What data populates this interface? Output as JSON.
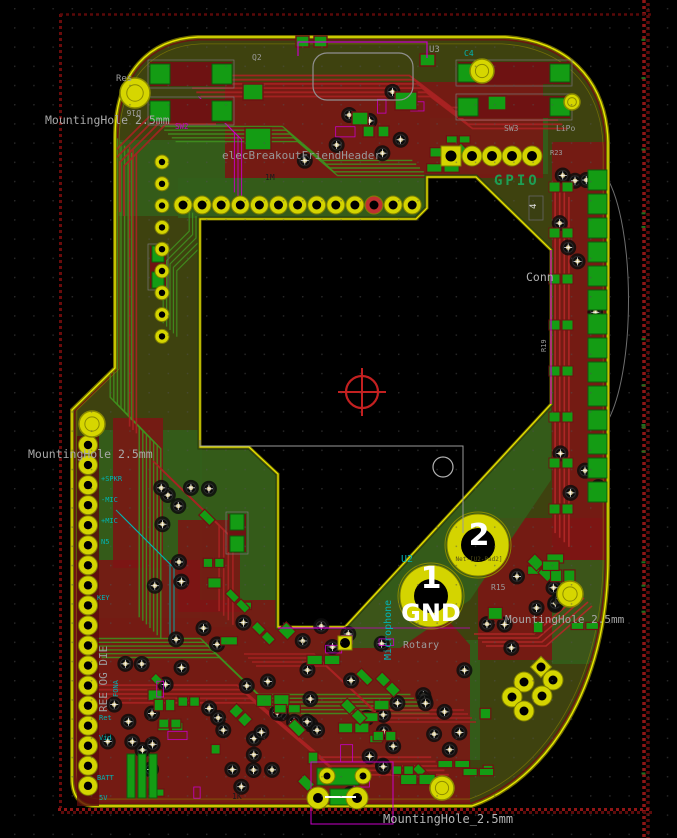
{
  "editor": {
    "view": "pcb-layout",
    "board_name": "elecBreakoutFriendHeader"
  },
  "palette": {
    "bg": "#000000",
    "grid_dot": "#505050",
    "board_base": "#3e420f",
    "zone_green": "#335f1b",
    "zone_red": "#7e1414",
    "trace_green": "#3f8f1e",
    "trace_red": "#a82222",
    "pad_yellow": "#d4d400",
    "pad_yellow_edge": "#7f7f00",
    "pad_green": "#149c14",
    "courtyard_red": "#6e1212",
    "edge_bright": "#e8e800",
    "edge_dim": "#6f6a00",
    "magenta": "#c800c8",
    "cyan": "#00b4b4",
    "gray_text": "#9c9c9c",
    "rail_red": "#8f1515",
    "via_tan": "#c9b97e",
    "white": "#ffffff",
    "gpio_green": "#1e9e54"
  },
  "grid": {
    "spacing": 19.2,
    "offset_x": 14,
    "offset_y": 8
  },
  "board": {
    "outline": "M198,37 L505,37 C565,40 606,78 608,142 L608,558 C608,690 545,780 472,806 L95,806 C80,806 72,796 72,778 L72,410 L115,368 L115,138 C115,72 150,39 198,37 Z",
    "cutout": "M200,219 L416,219 L427,208 L427,177 L476,177 L551,250 L551,404 L345,627 L278,627 L278,474 L249,447 L200,447 Z",
    "outer_arc": "M606,176 C636,225 636,375 606,424"
  },
  "zones": {
    "green_under": [
      {
        "rect": [
          116,
          140,
          116,
          76
        ]
      },
      {
        "rect": [
          88,
          430,
          114,
          188
        ]
      },
      {
        "rect": [
          200,
          450,
          78,
          177
        ]
      },
      {
        "rect": [
          300,
          640,
          180,
          120
        ]
      },
      {
        "rect": [
          430,
          118,
          118,
          56
        ]
      }
    ],
    "red": [
      {
        "rect": [
          225,
          82,
          318,
          96
        ]
      },
      {
        "rect": [
          552,
          142,
          54,
          418
        ]
      },
      {
        "path": "M72,560 L200,560 L200,600 L430,600 L470,645 L470,806 L72,806 Z"
      },
      {
        "rect": [
          478,
          518,
          130,
          142
        ]
      },
      {
        "rect": [
          113,
          418,
          50,
          150
        ]
      },
      {
        "rect": [
          178,
          520,
          62,
          92
        ]
      }
    ],
    "green_over": [
      {
        "rect": [
          178,
          178,
          248,
          40
        ]
      },
      {
        "path": "M348,626 L551,406 L551,480 L470,600 L400,648 L340,648 Z"
      },
      {
        "rect": [
          552,
          560,
          54,
          104
        ]
      }
    ]
  },
  "rails": {
    "right": {
      "x": 644,
      "x2": 648,
      "y1": 0,
      "y2": 838
    },
    "bottom": {
      "y": 809.5,
      "y2": 812.5,
      "x1": 58,
      "x2": 652
    },
    "left": {
      "x": 60.5,
      "y1": 14,
      "y2": 808
    },
    "top": {
      "y": 14.5,
      "x1": 60,
      "x2": 652
    }
  },
  "trace_bundles": [
    {
      "pts": [
        [
          121,
          142
        ],
        [
          121,
          408
        ],
        [
          150,
          438
        ],
        [
          150,
          628
        ]
      ],
      "n": 7,
      "sp": 3.6,
      "c": "#3f8f1e",
      "w": 1.4
    },
    {
      "pts": [
        [
          133,
          150
        ],
        [
          133,
          430
        ]
      ],
      "n": 3,
      "sp": 3.4,
      "c": "#a82222",
      "w": 1.6
    },
    {
      "pts": [
        [
          190,
          86
        ],
        [
          420,
          86
        ],
        [
          462,
          118
        ],
        [
          556,
          118
        ]
      ],
      "n": 6,
      "sp": 4.2,
      "c": "#a82222",
      "w": 1.8
    },
    {
      "pts": [
        [
          168,
          134
        ],
        [
          290,
          134
        ],
        [
          330,
          168
        ],
        [
          420,
          168
        ]
      ],
      "n": 5,
      "sp": 3.8,
      "c": "#3f8f1e",
      "w": 1.4
    },
    {
      "pts": [
        [
          562,
          190
        ],
        [
          562,
          540
        ]
      ],
      "n": 4,
      "sp": 4.6,
      "c": "#b42828",
      "w": 1.6
    },
    {
      "pts": [
        [
          92,
          648
        ],
        [
          210,
          648
        ],
        [
          268,
          704
        ],
        [
          420,
          704
        ]
      ],
      "n": 6,
      "sp": 3.8,
      "c": "#3f8f1e",
      "w": 1.4
    },
    {
      "pts": [
        [
          100,
          694
        ],
        [
          246,
          694
        ],
        [
          330,
          766
        ],
        [
          440,
          766
        ]
      ],
      "n": 5,
      "sp": 4.4,
      "c": "#a82222",
      "w": 1.8
    },
    {
      "pts": [
        [
          160,
          468
        ],
        [
          226,
          532
        ],
        [
          226,
          618
        ]
      ],
      "n": 4,
      "sp": 4.6,
      "c": "#a82222",
      "w": 1.6
    },
    {
      "pts": [
        [
          196,
          216
        ],
        [
          196,
          238
        ],
        [
          170,
          264
        ],
        [
          170,
          330
        ]
      ],
      "n": 5,
      "sp": 3.4,
      "c": "#3f8f1e",
      "w": 1.2
    },
    {
      "pts": [
        [
          250,
          660
        ],
        [
          320,
          660
        ],
        [
          380,
          716
        ],
        [
          470,
          716
        ]
      ],
      "n": 4,
      "sp": 4.0,
      "c": "#a82222",
      "w": 1.6
    },
    {
      "pts": [
        [
          480,
          640
        ],
        [
          540,
          640
        ],
        [
          586,
          600
        ]
      ],
      "n": 4,
      "sp": 4.0,
      "c": "#b42828",
      "w": 1.6
    },
    {
      "pts": [
        [
          118,
          210
        ],
        [
          118,
          160
        ],
        [
          160,
          118
        ],
        [
          210,
          118
        ]
      ],
      "n": 4,
      "sp": 4.0,
      "c": "#a82222",
      "w": 1.8
    },
    {
      "pts": [
        [
          202,
          100
        ],
        [
          238,
          136
        ],
        [
          238,
          196
        ]
      ],
      "n": 3,
      "sp": 3.6,
      "c": "#c800c8",
      "w": 1.0
    },
    {
      "pts": [
        [
          118,
          512
        ],
        [
          172,
          566
        ],
        [
          172,
          642
        ]
      ],
      "n": 2,
      "sp": 4.0,
      "c": "#00b4b4",
      "w": 1.0
    }
  ],
  "clusters": [
    {
      "type": "via",
      "x": 128,
      "y": 618,
      "w": 300,
      "h": 180,
      "n": 40,
      "seed": 11
    },
    {
      "type": "via",
      "x": 148,
      "y": 430,
      "w": 70,
      "h": 170,
      "n": 9,
      "seed": 21
    },
    {
      "type": "via",
      "x": 295,
      "y": 88,
      "w": 130,
      "h": 78,
      "n": 7,
      "seed": 31
    },
    {
      "type": "via",
      "x": 482,
      "y": 556,
      "w": 86,
      "h": 96,
      "n": 9,
      "seed": 41
    },
    {
      "type": "via",
      "x": 556,
      "y": 150,
      "w": 46,
      "h": 350,
      "n": 11,
      "seed": 51
    },
    {
      "type": "via",
      "x": 300,
      "y": 640,
      "w": 170,
      "h": 150,
      "n": 12,
      "seed": 61
    },
    {
      "type": "via",
      "x": 96,
      "y": 640,
      "w": 60,
      "h": 150,
      "n": 7,
      "seed": 71
    },
    {
      "type": "chip",
      "x": 140,
      "y": 628,
      "w": 290,
      "h": 165,
      "n": 24,
      "seed": 81
    },
    {
      "type": "chip",
      "x": 482,
      "y": 556,
      "w": 110,
      "h": 86,
      "n": 8,
      "seed": 91
    },
    {
      "type": "chip",
      "x": 205,
      "y": 495,
      "w": 70,
      "h": 115,
      "n": 5,
      "seed": 101
    },
    {
      "type": "chip",
      "x": 300,
      "y": 696,
      "w": 190,
      "h": 92,
      "n": 9,
      "seed": 111
    },
    {
      "type": "chip",
      "x": 430,
      "y": 120,
      "w": 110,
      "h": 50,
      "n": 4,
      "seed": 121
    },
    {
      "type": "magenta",
      "x": 150,
      "y": 630,
      "w": 260,
      "h": 160,
      "n": 8,
      "seed": 131
    },
    {
      "type": "magenta",
      "x": 300,
      "y": 90,
      "w": 140,
      "h": 70,
      "n": 3,
      "seed": 141
    }
  ],
  "pad_rows": [
    {
      "name": "display-header",
      "cx0": 183,
      "cy": 205,
      "dx": 19.1,
      "n": 13,
      "r": 9,
      "hole": 4.5,
      "special_index": 10
    },
    {
      "name": "gpio-header-round",
      "cx0": 472,
      "cy": 156,
      "dx": 20,
      "n": 4,
      "r": 10,
      "hole": 5
    }
  ],
  "pad_cols": [
    {
      "name": "left-edge-header",
      "cx": 88,
      "cy0": 445,
      "dy": 20.05,
      "n": 18,
      "r": 9.5,
      "hole": 4.2
    },
    {
      "name": "left-inner-header",
      "cx": 162,
      "cy0": 162,
      "dy": 21.8,
      "n": 9,
      "r": 7,
      "hole": 3.2
    }
  ],
  "square_pads": [
    {
      "x": 441,
      "y": 146,
      "s": 20,
      "hole": 5.5,
      "name": "gpio-pad-1"
    },
    {
      "x": 338,
      "y": 636,
      "s": 14,
      "hole": 5,
      "name": "mid-square-pad"
    }
  ],
  "mount_holes": [
    {
      "x": 135,
      "y": 93,
      "r": 15
    },
    {
      "x": 482,
      "y": 71,
      "r": 12
    },
    {
      "x": 572,
      "y": 102,
      "r": 8
    },
    {
      "x": 92,
      "y": 424,
      "r": 13
    },
    {
      "x": 570,
      "y": 594,
      "r": 13
    },
    {
      "x": 442,
      "y": 788,
      "r": 12
    }
  ],
  "big_pads": [
    {
      "x": 478,
      "y": 545,
      "ro": 31,
      "ri": 17,
      "label": "2"
    },
    {
      "x": 431,
      "y": 596,
      "ro": 31,
      "ri": 17,
      "label": "1"
    }
  ],
  "right_col": {
    "x": 588,
    "y0": 170,
    "dy": 24,
    "n": 14,
    "w": 19,
    "h": 20,
    "pairs": {
      "x1": 549,
      "x2": 562,
      "y0": 182,
      "dy": 46,
      "n": 8,
      "w": 11,
      "h": 10
    }
  },
  "two_pad_components": [
    {
      "x": 150,
      "y": 62,
      "w": 82,
      "h": 24,
      "horiz": true
    },
    {
      "x": 150,
      "y": 99,
      "w": 82,
      "h": 24,
      "horiz": true
    },
    {
      "x": 458,
      "y": 62,
      "w": 112,
      "h": 22,
      "horiz": true
    },
    {
      "x": 458,
      "y": 96,
      "w": 112,
      "h": 22,
      "horiz": true
    },
    {
      "x": 228,
      "y": 514,
      "w": 18,
      "h": 38,
      "horiz": false
    },
    {
      "x": 150,
      "y": 246,
      "w": 16,
      "h": 42,
      "horiz": false
    }
  ],
  "chips_explicit": [
    [
      245,
      128,
      26,
      22
    ],
    [
      363,
      126,
      11,
      11
    ],
    [
      378,
      126,
      11,
      11
    ],
    [
      296,
      36,
      13,
      11
    ],
    [
      314,
      36,
      13,
      11
    ],
    [
      395,
      92,
      22,
      18
    ],
    [
      243,
      84,
      20,
      16
    ],
    [
      420,
      54,
      15,
      12
    ],
    [
      488,
      96,
      18,
      14
    ],
    [
      352,
      112,
      16,
      13
    ]
  ],
  "battery_bars": {
    "x0": 127,
    "y": 754,
    "dx": 11,
    "n": 3,
    "w": 8,
    "h": 44
  },
  "module_u3": {
    "rect": [
      313,
      53,
      100,
      47
    ],
    "rx": 14,
    "magenta_path": "M298,56 L298,42 L427,42 L427,58"
  },
  "bottom_connector": {
    "body": [
      317,
      768,
      42,
      17
    ],
    "mid_rect": [
      330,
      789,
      26,
      16
    ],
    "pads_small": [
      [
        327,
        776
      ],
      [
        363,
        776
      ]
    ],
    "r_small": 8,
    "pads_big": [
      [
        318,
        798
      ],
      [
        357,
        798
      ]
    ],
    "r_big": 11,
    "outline": [
      311,
      762,
      82,
      62
    ],
    "white_line": [
      [
        325,
        797
      ],
      [
        356,
        797
      ]
    ]
  },
  "rotary": {
    "square": [
      541,
      667,
      15
    ],
    "pads": [
      [
        524,
        682
      ],
      [
        553,
        680
      ],
      [
        512,
        697
      ],
      [
        542,
        696
      ],
      [
        524,
        711
      ]
    ],
    "r": 10
  },
  "markers": {
    "crosshair": {
      "x": 362,
      "y": 392,
      "r": 16,
      "c": "#c42020"
    },
    "white_circle": {
      "x": 443,
      "y": 467,
      "r": 10,
      "c": "#b0b0b0"
    },
    "courtyard_line": "M200,440 L200,446 L463,446 L463,533",
    "pad4_tag": {
      "rect": [
        529,
        196,
        14,
        24
      ]
    }
  },
  "accent_lines": [
    {
      "d": "M278,628 L346,628",
      "c": "#c800c8",
      "w": 1.2
    },
    {
      "d": "M551,250 L551,404",
      "c": "#c800c8",
      "w": 1.2
    },
    {
      "d": "M346,628 L470,628",
      "c": "#c800c8",
      "w": 0.8
    }
  ],
  "texts": [
    {
      "n": "label-res",
      "t": "Res",
      "x": 116,
      "y": 81,
      "s": 9,
      "c": "#9c9c9c"
    },
    {
      "n": "mounting-hole-top",
      "t": "MountingHole 2.5mm",
      "x": 45,
      "y": 124,
      "s": 11.5,
      "c": "#a8a8a8"
    },
    {
      "n": "board-title",
      "t": "elecBreakoutFriendHeader",
      "x": 222,
      "y": 159,
      "s": 11,
      "c": "#999999"
    },
    {
      "n": "ref-u3",
      "t": "U3",
      "x": 429,
      "y": 52,
      "s": 9,
      "c": "#9c9c9c"
    },
    {
      "n": "ref-c4",
      "t": "C4",
      "x": 464,
      "y": 56,
      "s": 8,
      "c": "#00b4b4"
    },
    {
      "n": "ref-q2",
      "t": "Q2",
      "x": 252,
      "y": 60,
      "s": 8,
      "c": "#9c9c9c"
    },
    {
      "n": "ref-sw2",
      "t": "SW2",
      "x": 175,
      "y": 129,
      "s": 7.5,
      "c": "#c800c8"
    },
    {
      "n": "gpio-label",
      "t": "GPIO",
      "x": 494,
      "y": 185,
      "s": 14,
      "c": "#1e9e54",
      "b": 1,
      "ls": 3
    },
    {
      "n": "ref-sw3",
      "t": "SW3",
      "x": 504,
      "y": 131,
      "s": 8,
      "c": "#9c9c9c"
    },
    {
      "n": "ref-lipo",
      "t": "LiPo",
      "x": 556,
      "y": 131,
      "s": 8,
      "c": "#9c9c9c"
    },
    {
      "n": "ref-r23",
      "t": "R23",
      "x": 550,
      "y": 155,
      "s": 7,
      "c": "#9c9c9c"
    },
    {
      "n": "conn-label",
      "t": "Conn",
      "x": 526,
      "y": 281,
      "s": 11.5,
      "c": "#b0b0b0"
    },
    {
      "n": "mounting-hole-left",
      "t": "MountingHole 2.5mm",
      "x": 28,
      "y": 458,
      "s": 11.5,
      "c": "#a8a8a8"
    },
    {
      "n": "pad-label-spkr",
      "t": "+SPKR",
      "x": 101,
      "y": 481,
      "s": 7,
      "c": "#00b4b4"
    },
    {
      "n": "pad-label-mic-neg",
      "t": "-MIC",
      "x": 101,
      "y": 502,
      "s": 7,
      "c": "#00b4b4"
    },
    {
      "n": "pad-label-mic-pos",
      "t": "+MIC",
      "x": 101,
      "y": 523,
      "s": 7,
      "c": "#00b4b4"
    },
    {
      "n": "pad-label-n5",
      "t": "N5",
      "x": 101,
      "y": 544,
      "s": 7,
      "c": "#00b4b4"
    },
    {
      "n": "pad-label-key",
      "t": "KEY",
      "x": 97,
      "y": 600,
      "s": 7,
      "c": "#00b4b4"
    },
    {
      "n": "pad-label-ret",
      "t": "Ret",
      "x": 99,
      "y": 720,
      "s": 7,
      "c": "#00b4b4"
    },
    {
      "n": "pad-label-vid",
      "t": "Vid",
      "x": 99,
      "y": 740,
      "s": 7,
      "c": "#00b4b4"
    },
    {
      "n": "pad-label-batt",
      "t": "BATT",
      "x": 97,
      "y": 780,
      "s": 7,
      "c": "#00b4b4"
    },
    {
      "n": "pad-label-5v",
      "t": "5V",
      "x": 99,
      "y": 800,
      "s": 7,
      "c": "#00b4b4"
    },
    {
      "n": "vertical-silk-text",
      "t": "REE OG DIE",
      "x": 107,
      "y": 712,
      "s": 11,
      "c": "#9c9c9c",
      "r": -90
    },
    {
      "n": "vertical-fona",
      "t": "FONA",
      "x": 118,
      "y": 697,
      "s": 7,
      "c": "#00b4b4",
      "r": -90
    },
    {
      "n": "vertical-microphone",
      "t": "Microphone",
      "x": 391,
      "y": 660,
      "s": 10,
      "c": "#00b4b4",
      "r": -90
    },
    {
      "n": "ref-u2",
      "t": "U2",
      "x": 401,
      "y": 562,
      "s": 10,
      "c": "#00b4b4"
    },
    {
      "n": "net-label-pad2",
      "t": "Net-[U2-Pad2]",
      "x": 479,
      "y": 561,
      "s": 6,
      "c": "#55511a",
      "a": "middle"
    },
    {
      "n": "pad2-number",
      "t": "2",
      "x": 479,
      "y": 545,
      "s": 30,
      "c": "#ffffff",
      "a": "middle",
      "b": 1
    },
    {
      "n": "pad1-number",
      "t": "1",
      "x": 431,
      "y": 588,
      "s": 30,
      "c": "#ffffff",
      "a": "middle",
      "b": 1
    },
    {
      "n": "gnd-label",
      "t": "GND",
      "x": 431,
      "y": 621,
      "s": 24,
      "c": "#ffffff",
      "a": "middle",
      "b": 1
    },
    {
      "n": "rotary-label",
      "t": "Rotary",
      "x": 403,
      "y": 648,
      "s": 10,
      "c": "#9c9c9c"
    },
    {
      "n": "mounting-hole-right",
      "t": "MountingHole 2.5mm",
      "x": 505,
      "y": 623,
      "s": 11,
      "c": "#a8a8a8"
    },
    {
      "n": "mounting-hole-bottom",
      "t": "MountingHole_2.5mm",
      "x": 383,
      "y": 823,
      "s": 12,
      "c": "#b4b4b4"
    },
    {
      "n": "ref-r15",
      "t": "R15",
      "x": 491,
      "y": 590,
      "s": 8,
      "c": "#9c9c9c"
    },
    {
      "n": "val-1m",
      "t": "1M",
      "x": 265,
      "y": 180,
      "s": 8,
      "c": "#1c1c1c"
    },
    {
      "n": "val-1k",
      "t": "1K",
      "x": 232,
      "y": 799,
      "s": 8,
      "c": "#1c1c1c"
    },
    {
      "n": "ref-d16",
      "t": "D16",
      "x": 141,
      "y": 110,
      "s": 8,
      "c": "#9c9c9c",
      "r": 180
    },
    {
      "n": "pad4-number",
      "t": "4",
      "x": 536,
      "y": 209,
      "s": 9,
      "c": "#e0e0e0",
      "r": -90
    },
    {
      "n": "ref-r19",
      "t": "R19",
      "x": 546,
      "y": 352,
      "s": 7,
      "c": "#9c9c9c",
      "r": -90
    }
  ]
}
